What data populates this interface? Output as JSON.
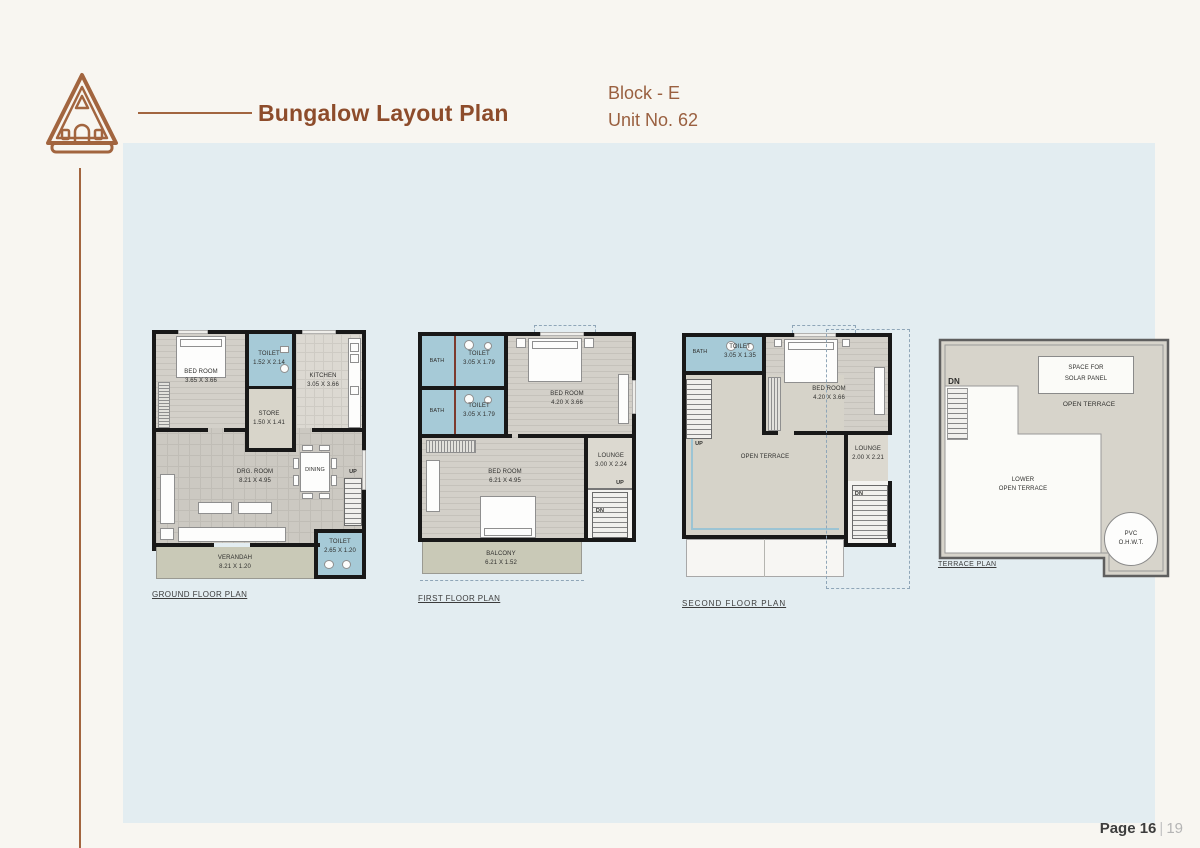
{
  "header": {
    "title": "Bungalow Layout Plan",
    "block": "Block - E",
    "unit": "Unit No. 62"
  },
  "footer": {
    "page": "Page 16",
    "sep": "|",
    "total": "19"
  },
  "colors": {
    "accent_brown": "#8d4c2b",
    "panel_blue": "#e3edf1",
    "wet_room_blue": "#a6cad7",
    "wall_black": "#181818"
  },
  "plans": {
    "ground": {
      "title": "GROUND FLOOR PLAN",
      "bedroom": "BED ROOM\n3.65 X 3.66",
      "toilet_top": "TOILET\n1.52 X 2.14",
      "kitchen": "KITCHEN\n3.05 X 3.66",
      "store": "STORE\n1.50 X 1.41",
      "drg_room": "DRG. ROOM\n8.21 X 4.95",
      "dining": "DINING",
      "up": "UP",
      "verandah": "VERANDAH\n8.21 X 1.20",
      "toilet_bottom": "TOILET\n2.65 X 1.20"
    },
    "first": {
      "title": "FIRST FLOOR PLAN",
      "bath_top": "BATH",
      "toilet_top": "TOILET\n3.05 X 1.79",
      "bath_mid": "BATH",
      "toilet_mid": "TOILET\n3.05 X 1.79",
      "bedroom_top": "BED ROOM\n4.20 X 3.66",
      "bedroom_bottom": "BED ROOM\n6.21 X 4.95",
      "lounge": "LOUNGE\n3.00 X 2.24",
      "up": "UP",
      "dn": "DN",
      "balcony": "BALCONY\n6.21 X 1.52"
    },
    "second": {
      "title": "SECOND FLOOR PLAN",
      "bath": "BATH",
      "toilet": "TOILET\n3.05 X 1.35",
      "bedroom": "BED ROOM\n4.20 X 3.66",
      "open_terrace": "OPEN TERRACE",
      "lounge": "LOUNGE\n2.00 X 2.21",
      "up": "UP",
      "dn": "DN"
    },
    "terrace": {
      "title": "TERRACE PLAN",
      "dn": "DN",
      "solar": "SPACE FOR\nSOLAR PANEL",
      "open_terrace": "OPEN TERRACE",
      "lower_terrace": "LOWER\nOPEN TERRACE",
      "water_tank": "PVC\nO.H.W.T."
    }
  }
}
